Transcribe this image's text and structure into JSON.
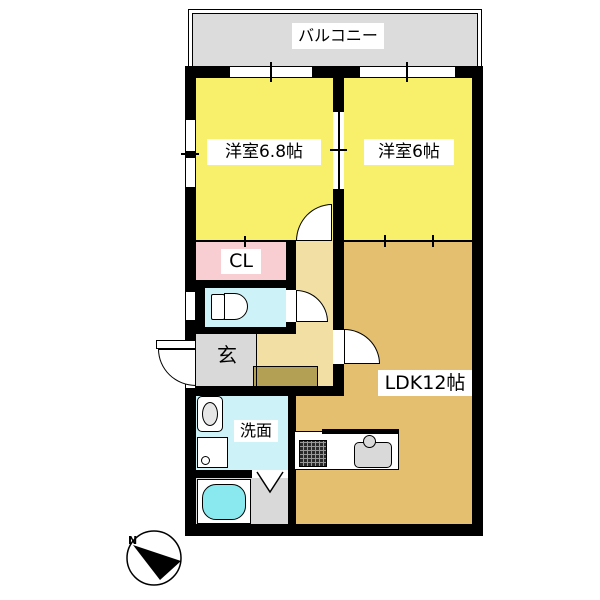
{
  "balcony": {
    "label": "バルコニー"
  },
  "rooms": {
    "western1": {
      "label": "洋室6.8帖"
    },
    "western2": {
      "label": "洋室6帖"
    },
    "closet": {
      "label": "CL"
    },
    "entrance": {
      "label": "玄"
    },
    "washroom": {
      "label": "洗面"
    },
    "ldk": {
      "label": "LDK12帖"
    }
  },
  "compass": {
    "north_label": "N"
  },
  "colors": {
    "room_yellow": "#f8f06a",
    "ldk_tan": "#e3bf6f",
    "hall_tan": "#f2dfa4",
    "closet_pink": "#f8ced2",
    "water_cyan": "#cdf2f8",
    "bathtub_cyan": "#8ae9ef",
    "gray_area": "#d9d9d9",
    "balcony_gray": "#dcdcdc",
    "step_khaki": "#b3a055",
    "wall": "#000000"
  }
}
